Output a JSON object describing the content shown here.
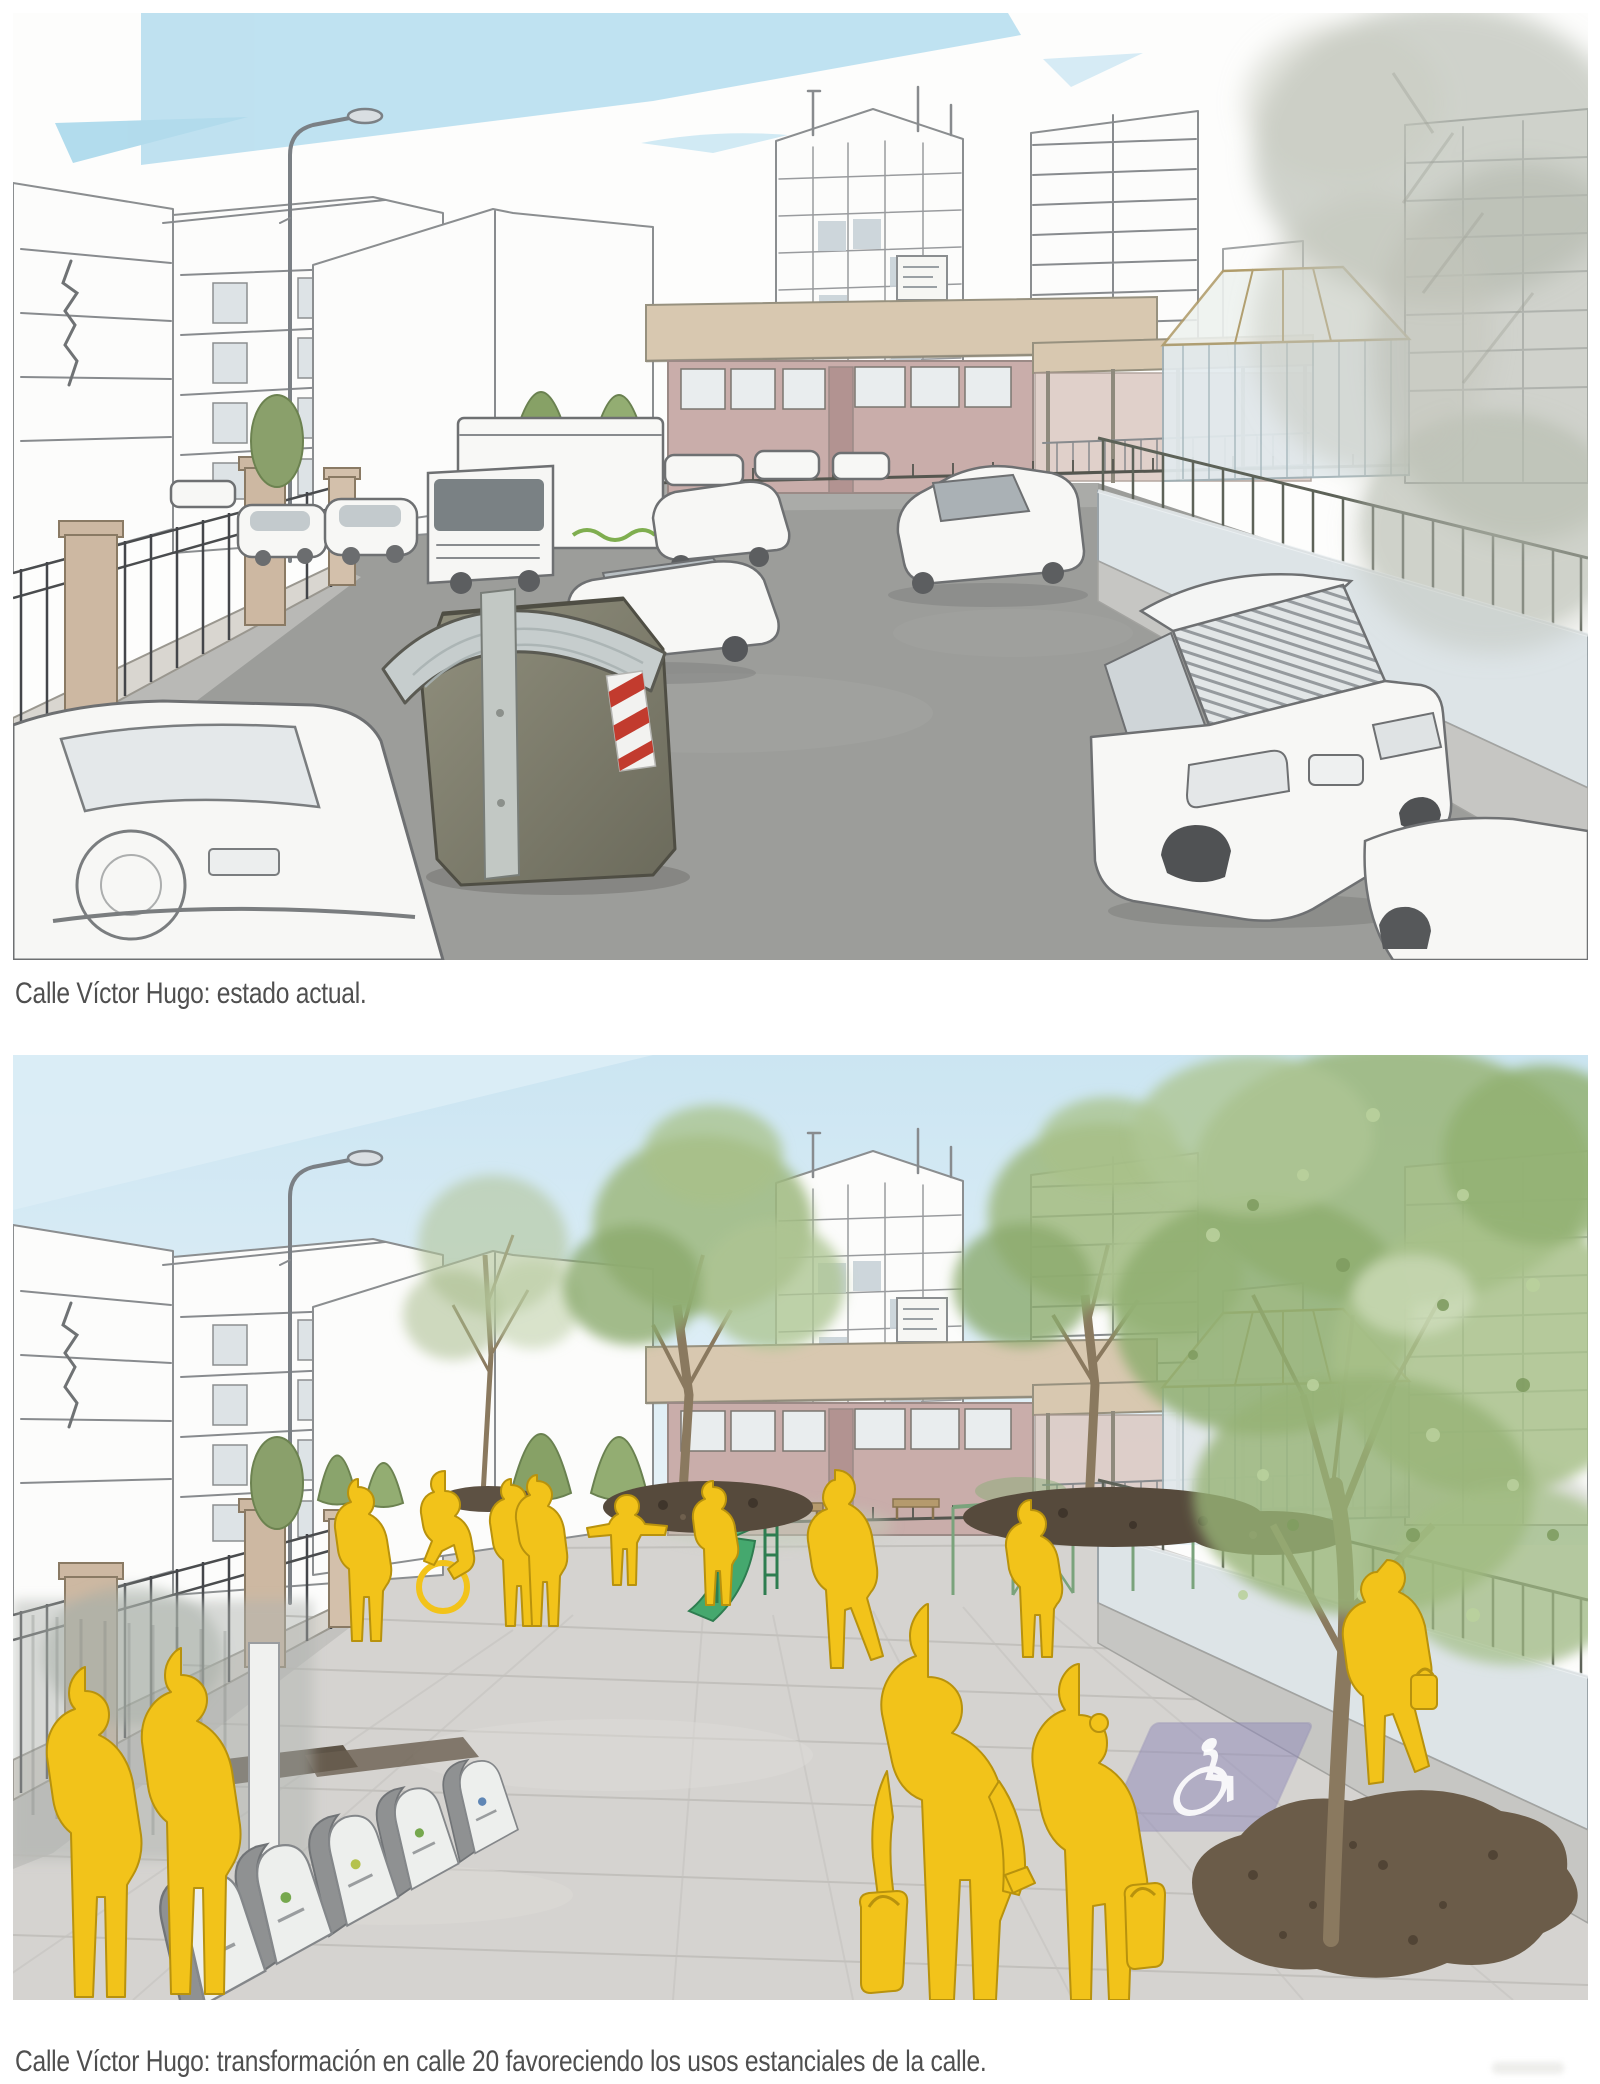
{
  "page": {
    "background": "#ffffff",
    "caption_color": "#4f4f4f"
  },
  "figures": [
    {
      "id": "before",
      "caption": "Calle Víctor Hugo: estado actual.",
      "type": "sketch-illustration",
      "scene": {
        "description": "Hand-drawn street view: the roadway of Calle Víctor Hugo filled with parked cars and a box truck in front of a school building; a large waste container stands in the street; iron fence with brick pillars on the left, low wall with railing on the right, apartment towers and a conservatory behind, faded tree in the top right corner, blue sky wedges above.",
        "elements": [
          "sky-wedges",
          "apartment-blocks",
          "street-lamp",
          "center-tower",
          "school-building",
          "conservatory",
          "waste-container",
          "box-truck",
          "parked-cars",
          "iron-fence",
          "right-wall",
          "roadway",
          "faded-tree"
        ],
        "palette": {
          "sky_wedge": "#bce0f0",
          "road": "#9c9d9a",
          "school_pink": "#c9adaa",
          "roof_band": "#d8c8b0",
          "sketch_line": "#8b8e90",
          "container_body": "#7d7c6b",
          "container_roof": "#c6cdcd",
          "sticker_red": "#c23b2e"
        }
      }
    },
    {
      "id": "after",
      "caption": "Calle Víctor Hugo: transformación en calle 20 favoreciendo los usos estanciales de la calle.",
      "type": "sketch-illustration",
      "scene": {
        "description": "Same view transformed into a shared 'calle 20' street: continuous paved plaza, new street trees with mulch beds, playground with green slide and climbing frame, row of recycling bollards, accessible parking marking, and yellow pedestrian silhouettes strolling, including a foreground couple with shopping bags under a large leafy tree.",
        "elements": [
          "blue-sky",
          "paved-plaza",
          "street-trees",
          "mulch-beds",
          "playground-slide",
          "climbing-frame",
          "recycling-bollards",
          "accessible-parking-marking",
          "yellow-pedestrians",
          "large-tree",
          "street-lamp",
          "school-building"
        ],
        "palette": {
          "sky": "#cde6f2",
          "pavement": "#d5d3d0",
          "pedestrian_yellow": "#f2c31a",
          "tree_green": "#9cb87f",
          "mulch_brown": "#6b5c49",
          "slide_green": "#45a86e",
          "parking_blue": "#8f89ba"
        }
      }
    }
  ]
}
